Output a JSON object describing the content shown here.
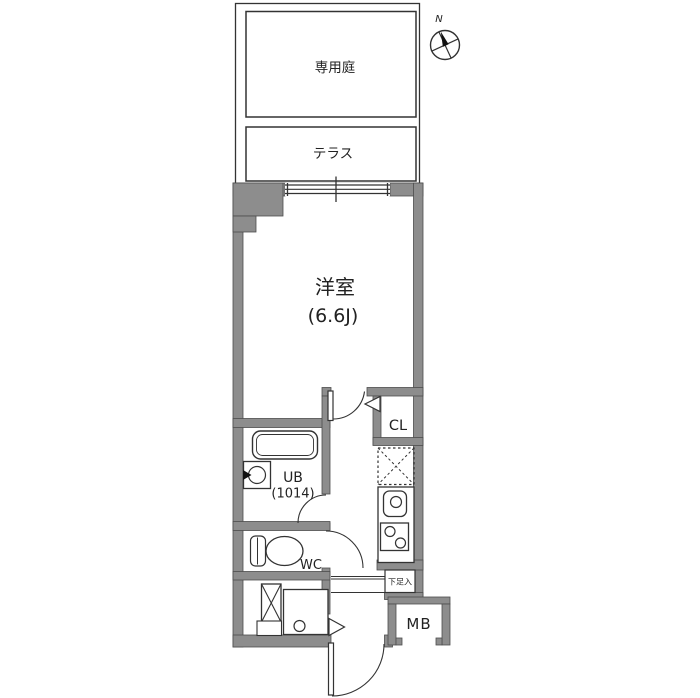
{
  "floorplan": {
    "compass": {
      "label": "N"
    },
    "outdoor": {
      "garden_label": "専用庭",
      "terrace_label": "テラス"
    },
    "rooms": {
      "main_room": {
        "label": "洋室",
        "size": "(6.6J)"
      },
      "closet": {
        "label": "CL"
      },
      "bath": {
        "label": "UB",
        "size": "(1014)"
      },
      "toilet": {
        "label": "WC"
      },
      "shoe_box": {
        "label": "下足入"
      },
      "meter_box": {
        "label": "MB"
      }
    },
    "colors": {
      "wall": "#8d8d8d",
      "line": "#333333",
      "background": "#ffffff"
    }
  }
}
